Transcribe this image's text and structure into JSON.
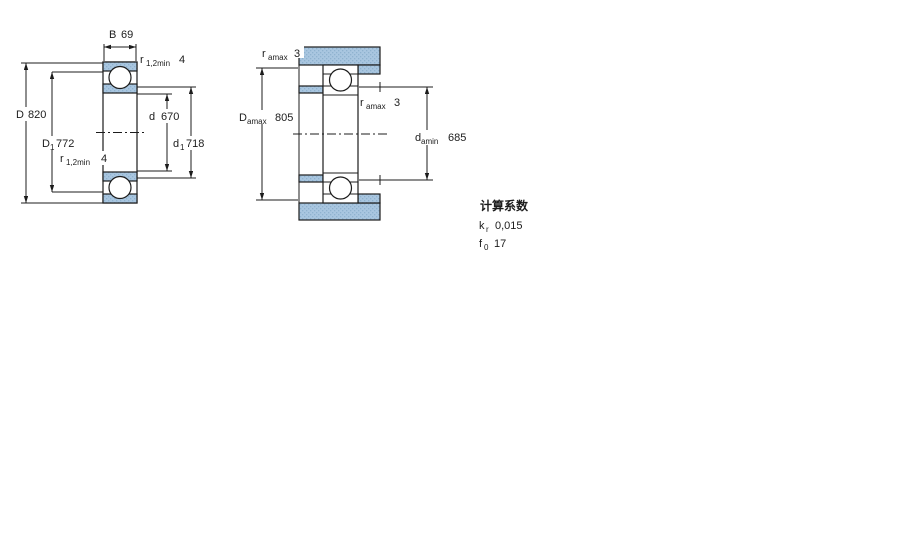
{
  "drawing": {
    "left": {
      "B": {
        "symbol": "B",
        "value": "69"
      },
      "r_top": {
        "symbol": "r",
        "sub": "1,2min",
        "value": "4"
      },
      "D": {
        "symbol": "D",
        "value": "820"
      },
      "D1": {
        "symbol": "D",
        "sub": "1",
        "value": "772"
      },
      "r_bottom": {
        "symbol": "r",
        "sub": "1,2min",
        "value": "4"
      },
      "d": {
        "symbol": "d",
        "value": "670"
      },
      "d1": {
        "symbol": "d",
        "sub": "1",
        "value": "718"
      }
    },
    "right": {
      "ra_top": {
        "symbol": "r",
        "sub": "amax",
        "value": "3"
      },
      "Da": {
        "symbol": "D",
        "sub": "amax",
        "value": "805"
      },
      "ra_mid": {
        "symbol": "r",
        "sub": "amax",
        "value": "3"
      },
      "da": {
        "symbol": "d",
        "sub": "amin",
        "value": "685"
      }
    },
    "factors": {
      "title": "计算系数",
      "rows": [
        {
          "symbol": "k",
          "sub": "r",
          "value": "0,015"
        },
        {
          "symbol": "f",
          "sub": "0",
          "value": "17"
        }
      ]
    },
    "colors": {
      "section_fill": "#a9c6e0",
      "section_dot": "#8fb2cf",
      "line": "#1c1c1c"
    }
  }
}
